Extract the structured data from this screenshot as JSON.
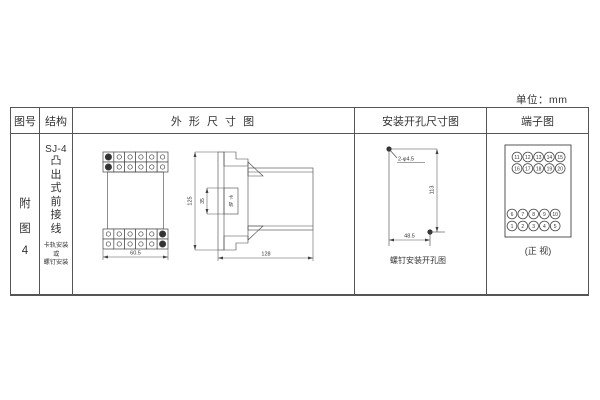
{
  "page": {
    "unit_label": "单位：mm"
  },
  "table": {
    "headers": [
      "图号",
      "结构",
      "外 形 尺 寸 图",
      "安装开孔尺寸图",
      "端子图"
    ]
  },
  "row": {
    "figure_label_chars": [
      "附",
      "图",
      "4"
    ],
    "structure": {
      "model": "SJ-4",
      "type_chars": [
        "凸",
        "出",
        "式",
        "前",
        "接",
        "线"
      ],
      "mount_lines": [
        "卡轨安装",
        "或",
        "螺钉安装"
      ]
    },
    "outline_drawing": {
      "width_dim": "60.5",
      "height_dim": "125",
      "depth_dim": "128",
      "rail_dim": "35",
      "rail_label_chars": [
        "卡",
        "轨"
      ]
    },
    "mounting_drawing": {
      "holes_label": "2-φ4.5",
      "vertical_dim": "113",
      "horizontal_dim": "48.5",
      "caption": "螺钉安装开孔图"
    },
    "terminal_drawing": {
      "top_rows": [
        [
          "11",
          "12",
          "13",
          "14",
          "15"
        ],
        [
          "16",
          "17",
          "18",
          "19",
          "20"
        ]
      ],
      "bottom_rows": [
        [
          "6",
          "7",
          "8",
          "9",
          "10"
        ],
        [
          "1",
          "2",
          "3",
          "4",
          "5"
        ]
      ],
      "caption": "(正 视)"
    }
  }
}
